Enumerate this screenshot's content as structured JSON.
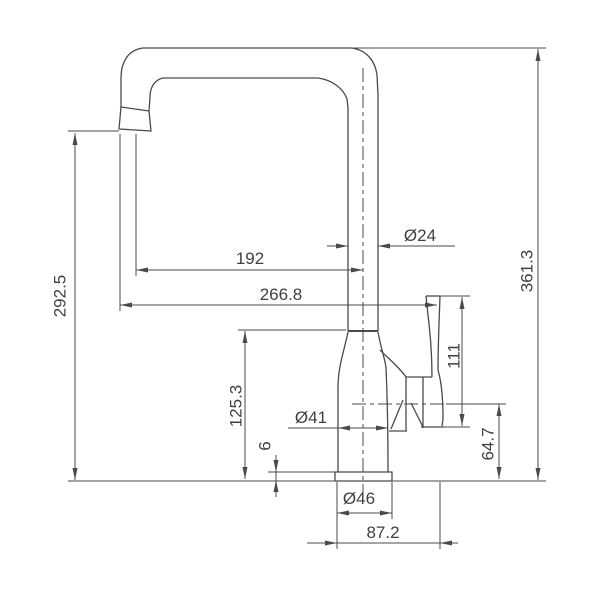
{
  "drawing": {
    "title": "faucet-technical-drawing",
    "colors": {
      "line": "#4a4a4a",
      "text": "#404040",
      "background": "#ffffff"
    },
    "dimensions": {
      "spout_height": "292.5",
      "spout_reach": "192",
      "overall_reach": "266.8",
      "spout_tube_diameter": "Ø24",
      "overall_height": "361.3",
      "handle_height": "111",
      "body_height": "125.3",
      "body_diameter": "Ø41",
      "base_plate_thickness": "6",
      "pivot_height": "64.7",
      "base_diameter": "Ø46",
      "footprint_width": "87.2"
    }
  }
}
